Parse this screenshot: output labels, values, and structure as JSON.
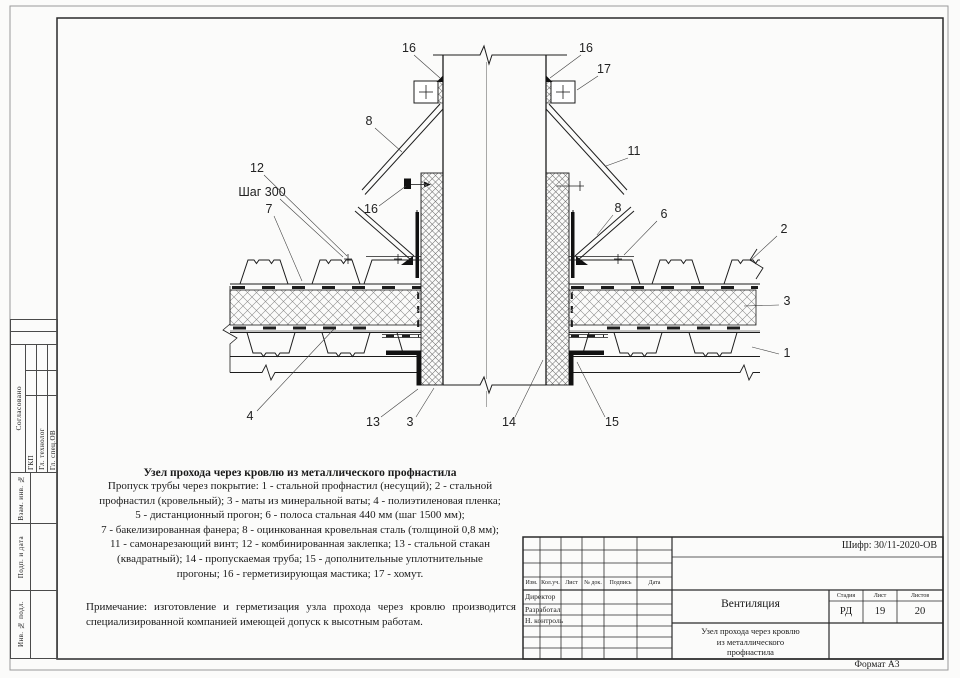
{
  "sheet": {
    "format_label": "Формат А3",
    "code_label": "Шифр: 30/11-2020-ОВ"
  },
  "left_stamp": {
    "agreed": "Согласовано",
    "gkp": "ГКП",
    "gl_tech": "Гл. технолог",
    "gl_spec": "Гл. спец.ОВ",
    "vzam": "Взам. инв. №",
    "podp": "Подп. и дата",
    "inv": "Инв. № подл."
  },
  "title_block": {
    "header_cols": [
      "Изм.",
      "Кол.уч.",
      "Лист",
      "№ док.",
      "Подпись",
      "Дата"
    ],
    "roles": [
      "Директор",
      "Разработал",
      "Н. контроль"
    ],
    "project": "Вентиляция",
    "stage_label": "Стадия",
    "sheet_label": "Лист",
    "sheets_label": "Листов",
    "stage": "РД",
    "sheet_no": "19",
    "sheets_total": "20",
    "title_lines": [
      "Узел прохода через кровлю",
      "из металлического",
      "профнастила"
    ]
  },
  "description": {
    "title": "Узел прохода через кровлю из металлического профнастила",
    "lines": [
      "Пропуск трубы через покрытие: 1 - стальной профнастил (несущий); 2 - стальной",
      "профнастил (кровельный); 3 - маты из минеральной ваты; 4 - полиэтиленовая пленка;",
      "5 - дистанционный прогон; 6 - полоса стальная 440 мм (шаг 1500 мм);",
      "7 - бакелизированная фанера; 8 - оцинкованная кровельная сталь (толщиной 0,8 мм);",
      "11 - самонарезающий винт; 12 - комбинированная заклепка; 13 - стальной стакан",
      "(квадратный); 14 - пропускаемая труба; 15 - дополнительные уплотнительные",
      "прогоны; 16 - герметизирующая мастика; 17 - хомут."
    ],
    "note": "Примечание: изготовление и герметизация узла прохода через кровлю производится специализированной компанией имеющей допуск к высотным работам."
  },
  "callouts": {
    "n1": "1",
    "n2": "2",
    "n3": "3",
    "n4": "4",
    "n6": "6",
    "n7": "7",
    "n8": "8",
    "n11": "11",
    "n12": "12",
    "n13": "13",
    "n14": "14",
    "n15": "15",
    "n16": "16",
    "n17": "17",
    "shag": "Шаг 300"
  },
  "colors": {
    "line": "#1c1c1c",
    "paper": "#ffffff",
    "hatch": "#8a8a8a"
  }
}
